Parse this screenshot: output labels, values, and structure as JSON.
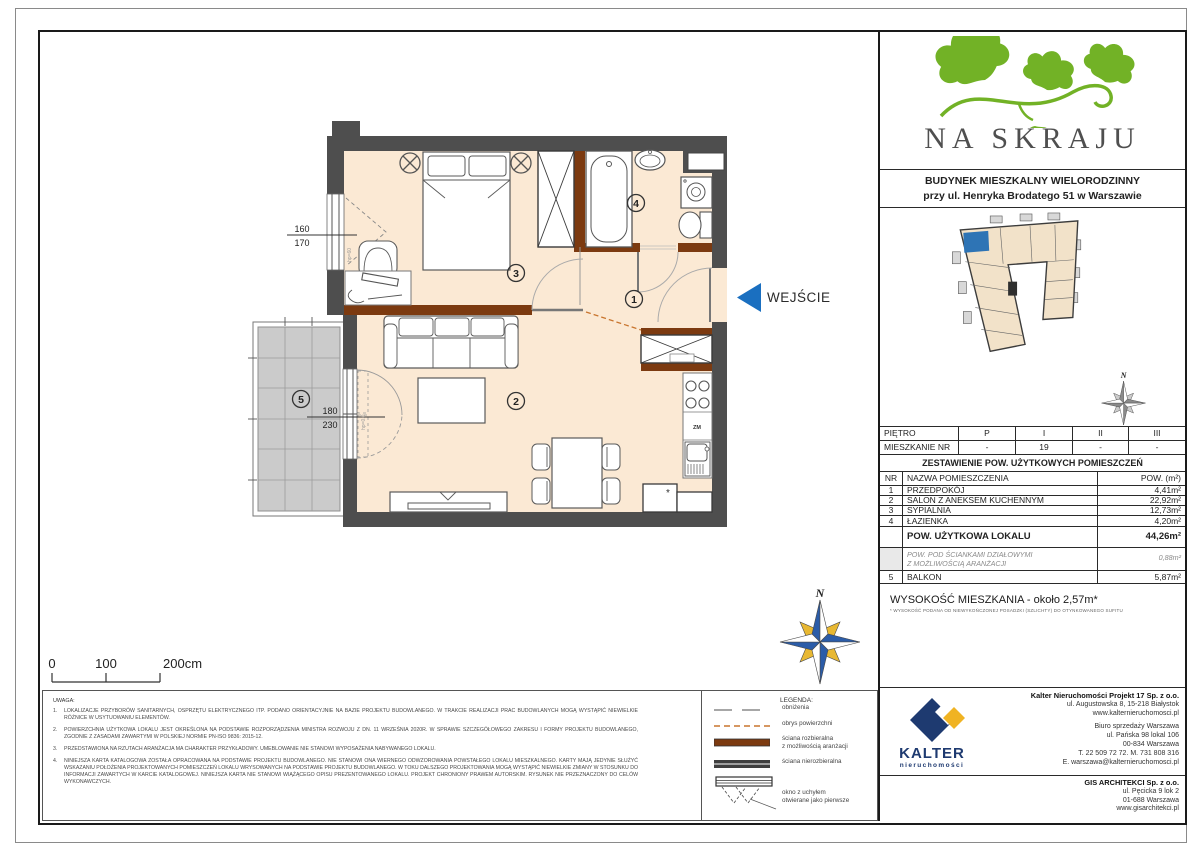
{
  "header": {
    "project_name": "NA SKRAJU",
    "building_line1": "BUDYNEK MIESZKALNY WIELORODZINNY",
    "building_line2": "przy ul. Henryka Brodatego 51 w Warszawie"
  },
  "floor_table": {
    "floor_label": "PIĘTRO",
    "unit_label": "MIESZKANIE NR",
    "columns": [
      "P",
      "I",
      "II",
      "III"
    ],
    "values": [
      "-",
      "19",
      "-",
      "-"
    ]
  },
  "area_table": {
    "title": "ZESTAWIENIE POW. UŻYTKOWYCH POMIESZCZEŃ",
    "col_nr": "NR",
    "col_name": "NAZWA POMIESZCZENIA",
    "col_area": "POW. (m²)",
    "rows": [
      {
        "nr": "1",
        "name": "PRZEDPOKÓJ",
        "area": "4,41m²"
      },
      {
        "nr": "2",
        "name": "SALON Z ANEKSEM KUCHENNYM",
        "area": "22,92m²"
      },
      {
        "nr": "3",
        "name": "SYPIALNIA",
        "area": "12,73m²"
      },
      {
        "nr": "4",
        "name": "ŁAZIENKA",
        "area": "4,20m²"
      }
    ],
    "total_label": "POW. UŻYTKOWA LOKALU",
    "total_area": "44,26m²",
    "partition_label1": "POW. POD ŚCIANKAMI DZIAŁOWYMI",
    "partition_label2": "Z MOŻLIWOŚCIĄ ARANŻACJI",
    "partition_area": "0,88m²",
    "balcony_nr": "5",
    "balcony_label": "BALKON",
    "balcony_area": "5,87m²"
  },
  "height": {
    "text": "WYSOKOŚĆ MIESZKANIA - około 2,57m*",
    "footnote": "* WYSOKOŚĆ PODANA OD NIEWYKOŃCZONEJ POSADZKI (SZLICHTY) DO OTYNKOWANEGO SUFITU"
  },
  "plan": {
    "entrance_label": "WEJŚCIE",
    "room_numbers": {
      "hall": "1",
      "living": "2",
      "bedroom": "3",
      "bath": "4",
      "balcony": "5"
    },
    "window_dim_top": "160",
    "window_dim_bottom": "170",
    "door_dim_top": "180",
    "door_dim_bottom": "230",
    "window_hp": "hp=60",
    "door_hp": "hp=0.0",
    "dishwasher_label": "ZM",
    "fridge_mark": "*",
    "north_label": "N"
  },
  "scale_bar": {
    "t0": "0",
    "t100": "100",
    "t200": "200cm"
  },
  "notes": {
    "title": "UWAGA:",
    "items": [
      {
        "n": "1.",
        "text": "LOKALIZACJE PRZYBORÓW SANITARNYCH, OSPRZĘTU ELEKTRYCZNEGO ITP. PODANO ORIENTACYJNIE NA BAZIE PROJEKTU BUDOWLANEGO. W TRAKCIE REALIZACJI PRAC BUDOWLANYCH MOGĄ WYSTĄPIĆ NIEWIELKIE RÓŻNICE W USYTUOWANIU ELEMENTÓW."
      },
      {
        "n": "2.",
        "text": "POWIERZCHNIA UŻYTKOWA LOKALU JEST OKREŚLONA NA PODSTAWIE ROZPORZĄDZENIA MINISTRA ROZWOJU Z DN. 11 WRZEŚNIA 2020R. W SPRAWIE SZCZEGÓŁOWEGO ZAKRESU I FORMY PROJEKTU BUDOWLANEGO, ZGODNIE Z ZASADAMI ZAWARTYMI W POLSKIEJ NORMIE PN-ISO 9836: 2015-12."
      },
      {
        "n": "3.",
        "text": "PRZEDSTAWIONA NA RZUTACH ARANŻACJA MA CHARAKTER PRZYKŁADOWY. UMEBLOWANIE NIE STANOWI WYPOSAŻENIA NABYWANEGO LOKALU."
      },
      {
        "n": "4.",
        "text": "NINIEJSZA KARTA KATALOGOWA ZOSTAŁA OPRACOWANA NA PODSTAWIE PROJEKTU BUDOWLANEGO. NIE STANOWI ONA WIERNEGO ODWZOROWANIA POWSTAŁEGO LOKALU MIESZKALNEGO. KARTY MAJĄ JEDYNIE SŁUŻYĆ WSKAZANIU POŁOŻENIA PROJEKTOWANYCH POMIESZCZEŃ LOKALU WRYSOWANYCH NA PODSTAWIE PROJEKTU BUDOWLANEGO. W TOKU DALSZEGO PROJEKTOWANIA MOGĄ WYSTĄPIĆ NIEWIELKIE ZMIANY W STOSUNKU DO INFORMACJI ZAWARTYCH W KARCIE KATALOGOWEJ. NINIEJSZA KARTA NIE STANOWI WIĄŻĄCEGO OPISU PREZENTOWANEGO LOKALU. PROJEKT CHRONIONY PRAWEM AUTORSKIM. RYSUNEK NIE PRZEZNACZONY DO CELÓW WYKONAWCZYCH."
      }
    ]
  },
  "legend": {
    "title": "LEGENDA:",
    "items": [
      {
        "l1": "obniżenia",
        "l2": ""
      },
      {
        "l1": "obrys powierzchni",
        "l2": ""
      },
      {
        "l1": "ściana rozbieralna",
        "l2": "z możliwością aranżacji"
      },
      {
        "l1": "ściana nierozbieralna",
        "l2": ""
      },
      {
        "l1": "okno z uchyłem",
        "l2": "otwierane jako pierwsze"
      }
    ]
  },
  "companies": {
    "kalter": {
      "name": "Kalter Nieruchomości Projekt 17 Sp. z o.o.",
      "addr": "ul. Augustowska 8, 15-218 Białystok",
      "web": "www.kalternieruchomosci.pl",
      "office": "Biuro sprzedaży Warszawa",
      "office_addr": "ul. Pańska 98 lokal 106",
      "office_city": "00-834 Warszawa",
      "phones": "T. 22 509 72 72. M. 731 808 316",
      "email": "E. warszawa@kalternieruchomosci.pl",
      "logo_text": "KALTER",
      "logo_sub": "nieruchomości"
    },
    "gis": {
      "name": "GIS ARCHITEKCI Sp. z o.o.",
      "addr": "ul. Pęcicka 9 lok 2",
      "city": "01-688 Warszawa",
      "web": "www.gisarchitekci.pl"
    }
  },
  "colors": {
    "wall": "#4e4e4e",
    "removable_wall": "#7c3a10",
    "floor": "#fbe9d4",
    "entrance_blue": "#1a6fc0",
    "logo_green": "#72b226",
    "kalter_navy": "#1e3a70",
    "kalter_yellow": "#f0b323",
    "outline_orange": "#c9752e"
  }
}
